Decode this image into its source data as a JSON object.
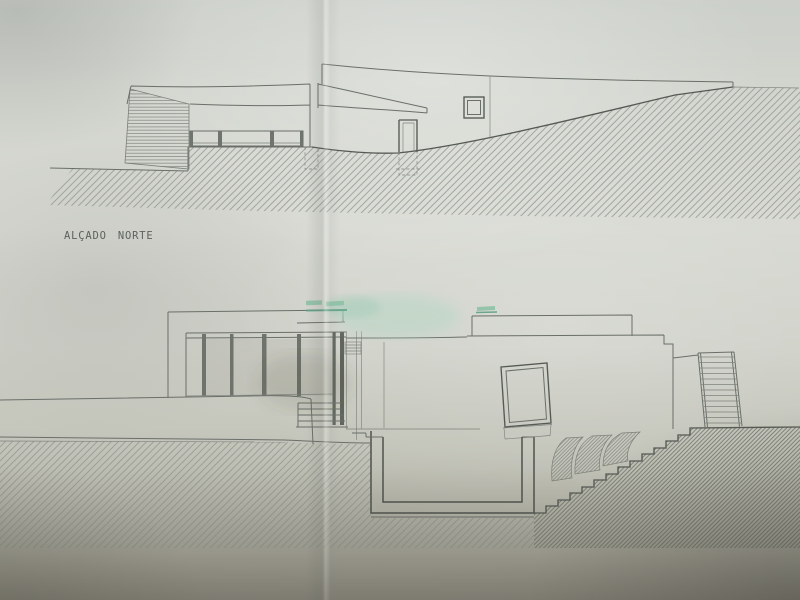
{
  "labels": {
    "north_elevation": "ALÇADO NORTE"
  },
  "colors": {
    "paper": "#d4d6cf",
    "paper_shadow": "#96948a",
    "ink": "#6a6f69",
    "ink_dark": "#555a54",
    "hatch_light": "#8e948d",
    "hatch_dense": "#6d7267",
    "highlighter_green": "#8ec2a7",
    "highlighter_soft": "#b7d7c5",
    "highlighter_dark": "#5fa487"
  }
}
